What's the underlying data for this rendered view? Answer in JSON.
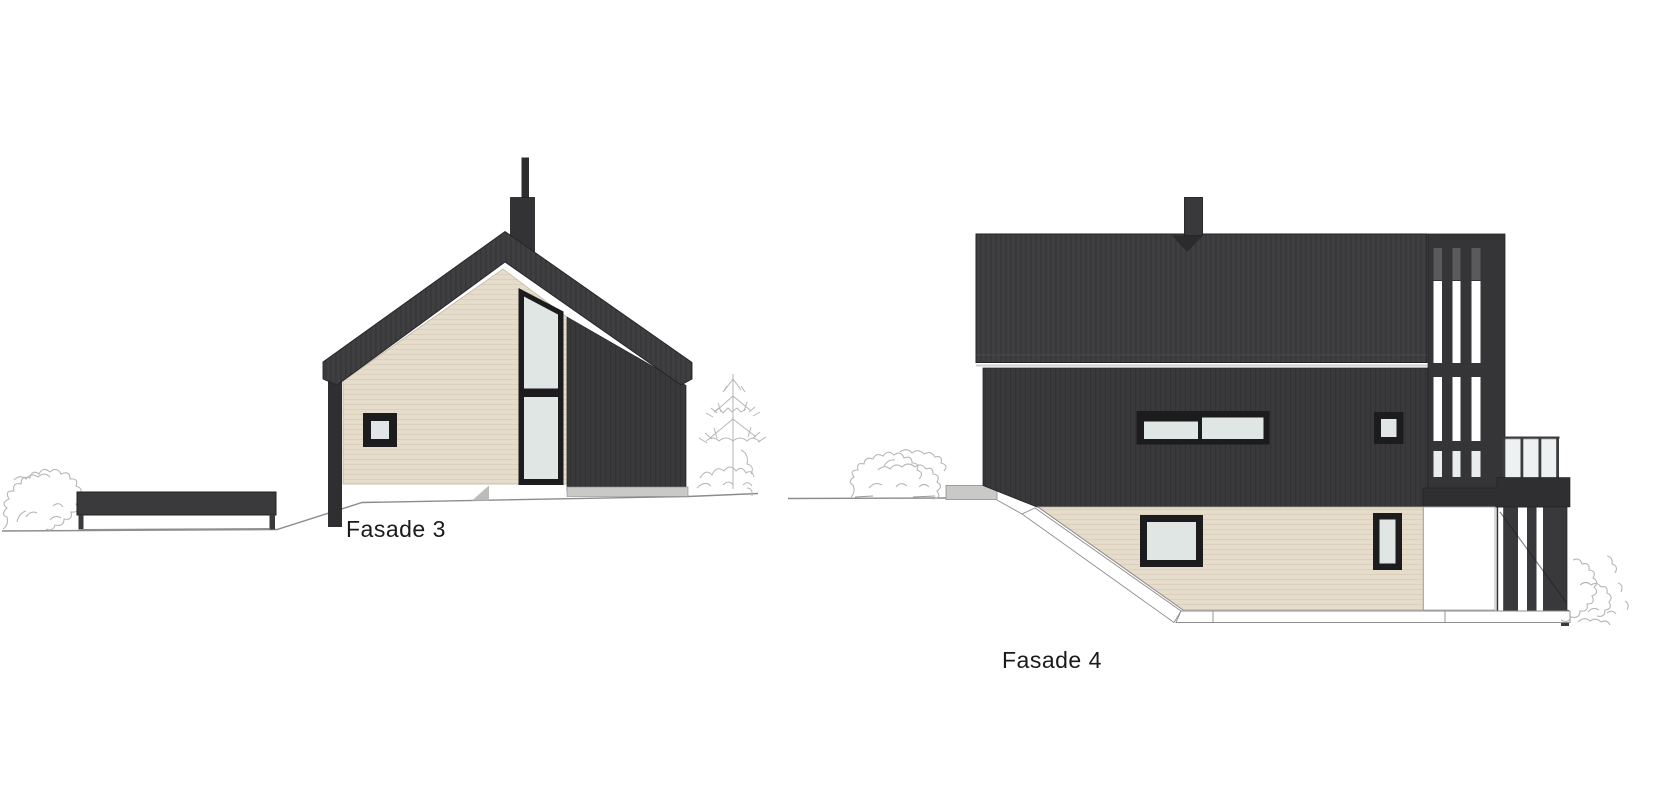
{
  "page": {
    "background_color": "#ffffff"
  },
  "drawings": {
    "fasade3": {
      "label": "Fasade 3",
      "features": [
        "gable-house-elevation",
        "wood-siding-gable-wall",
        "tall-split-window",
        "small-square-window",
        "chimney",
        "carport-wall",
        "fir-tree-sketch",
        "shrub-sketch"
      ]
    },
    "fasade4": {
      "label": "Fasade 4",
      "features": [
        "two-storey-house-elevation",
        "dark-roof-slab",
        "chimney",
        "ribbon-window",
        "square-window",
        "vertical-slat-screen",
        "glass-balcony-railing",
        "wood-siding-basement",
        "garage-panel",
        "retaining-step",
        "shrub-sketch"
      ]
    }
  },
  "colors": {
    "cladding_dark": "#39393b",
    "cladding_darker": "#2f2f31",
    "roof_dark": "#3f3f41",
    "outline_dark": "#202022",
    "cladding_wood": "#e6dccb",
    "siding_line": "#d9cdb9",
    "glass": "#dfe6e3",
    "railing_glass": "#edf1f1",
    "window_frame": "#1c1c1e",
    "sketch_gray": "#b6b6b6",
    "ground_line": "#8c8c8c",
    "step_gray": "#c9c9c7",
    "label_text": "#1a1a1a"
  }
}
